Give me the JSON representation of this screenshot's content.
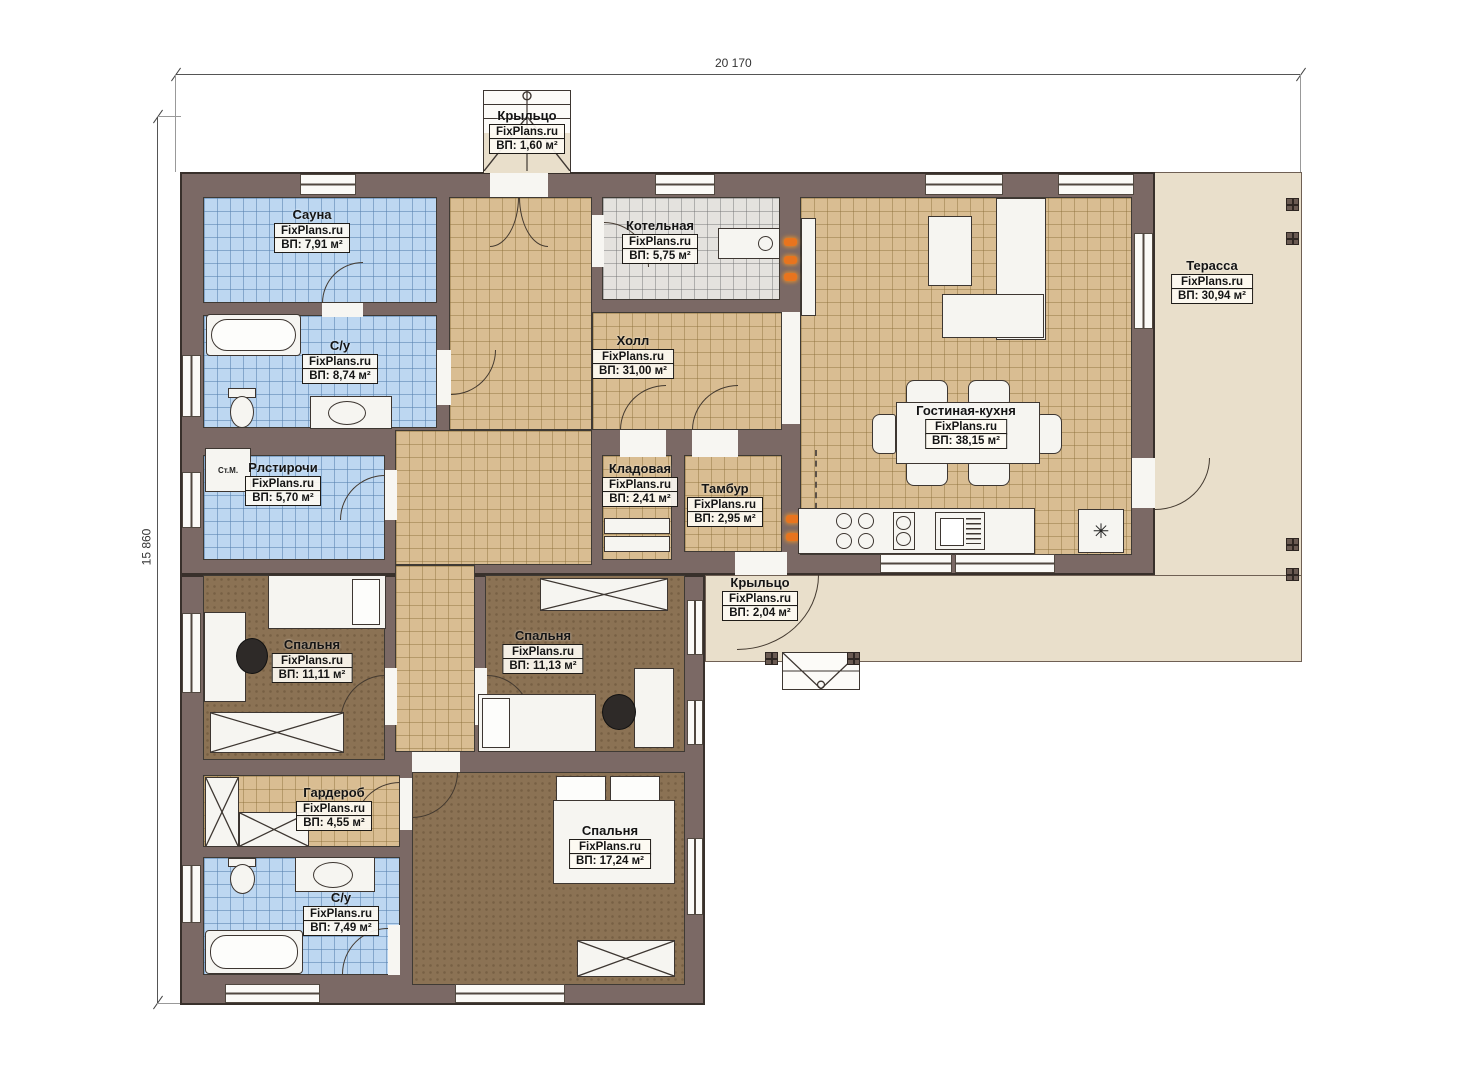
{
  "meta": {
    "brand": "FixPlans.ru"
  },
  "dimensions": {
    "width_label": "20 170",
    "height_label": "15 860"
  },
  "rooms": {
    "porch_top": {
      "name": "Крыльцо",
      "area": "ВП: 1,60 м²"
    },
    "sauna": {
      "name": "Сауна",
      "area": "ВП: 7,91 м²"
    },
    "bath_top": {
      "name": "С/у",
      "area": "ВП: 8,74 м²"
    },
    "boiler": {
      "name": "Котельная",
      "area": "ВП: 5,75 м²"
    },
    "hall": {
      "name": "Холл",
      "area": "ВП: 31,00 м²"
    },
    "living_kitchen": {
      "name": "Гостиная-кухня",
      "area": "ВП: 38,15 м²"
    },
    "terrace": {
      "name": "Терасса",
      "area": "ВП: 30,94 м²"
    },
    "laundry": {
      "name": "Рлстирочи",
      "area": "ВП: 5,70 м²"
    },
    "pantry": {
      "name": "Кладовая",
      "area": "ВП: 2,41 м²"
    },
    "vestibule": {
      "name": "Тамбур",
      "area": "ВП: 2,95 м²"
    },
    "porch_bottom": {
      "name": "Крыльцо",
      "area": "ВП: 2,04 м²"
    },
    "bedroom_left": {
      "name": "Спальня",
      "area": "ВП: 11,11 м²"
    },
    "bedroom_mid": {
      "name": "Спальня",
      "area": "ВП: 11,13 м²"
    },
    "wardrobe": {
      "name": "Гардероб",
      "area": "ВП: 4,55 м²"
    },
    "bath_bottom": {
      "name": "С/у",
      "area": "ВП: 7,49 м²"
    },
    "bedroom_bottom": {
      "name": "Спальня",
      "area": "ВП: 17,24 м²"
    }
  },
  "appliances": {
    "washing_machine": "Ст.М.",
    "fridge_symbol": "✳"
  },
  "colors": {
    "wall": "#7b6965",
    "tile_blue": "#bdd7f1",
    "tile_tan": "#d9bd92",
    "tile_gray": "#e4e2de",
    "floor_brown": "#8b7254",
    "terrace_beige": "#e9dfcb",
    "radiator_orange": "#e8741e",
    "paper": "#ffffff"
  }
}
